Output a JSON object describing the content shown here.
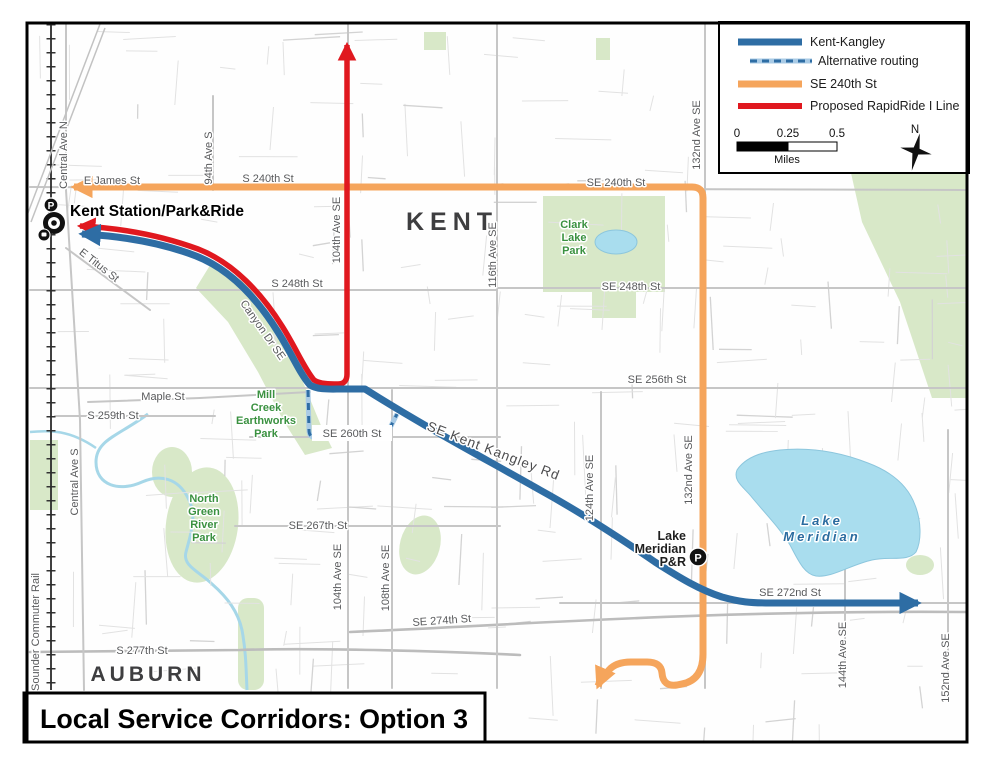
{
  "title_box": {
    "title": "Local Service Corridors: Option 3"
  },
  "legend": {
    "items": [
      {
        "label": "Kent-Kangley"
      },
      {
        "label": "Alternative routing"
      },
      {
        "label": "SE 240th St"
      },
      {
        "label": "Proposed RapidRide I Line"
      }
    ],
    "scale": {
      "ticks": [
        "0",
        "0.25",
        "0.5"
      ],
      "unit": "Miles"
    },
    "compass_n": "N"
  },
  "icons": {
    "p_badge": "P"
  },
  "colors": {
    "kent_kangley_blue": "#2e6da4",
    "alternative_light_blue": "#a9cbe6",
    "se_240th_orange": "#f5a55c",
    "rapidride_red": "#e0181f",
    "lake_blue": "#a9ddee",
    "park_green": "#d8e8c8",
    "park_text_green": "#3a9140"
  },
  "map_labels": [
    {
      "text": "E James St",
      "x": 112,
      "y": 184
    },
    {
      "text": "S 240th St",
      "x": 268,
      "y": 182
    },
    {
      "text": "SE 240th St",
      "x": 616,
      "y": 186
    },
    {
      "text": "S 248th St",
      "x": 297,
      "y": 287
    },
    {
      "text": "SE 248th St",
      "x": 631,
      "y": 290
    },
    {
      "text": "SE 256th St",
      "x": 657,
      "y": 383
    },
    {
      "text": "SE 260th St",
      "x": 352,
      "y": 437
    },
    {
      "text": "SE 267th St",
      "x": 318,
      "y": 529
    },
    {
      "text": "SE 272nd St",
      "x": 790,
      "y": 596
    },
    {
      "text": "SE 274th St",
      "x": 442,
      "y": 624,
      "rot": -4
    },
    {
      "text": "S 277th St",
      "x": 142,
      "y": 654
    },
    {
      "text": "S 259th St",
      "x": 113,
      "y": 419
    },
    {
      "text": "Maple St",
      "x": 163,
      "y": 400
    },
    {
      "text": "E Titus St",
      "x": 97,
      "y": 268,
      "rot": 38
    },
    {
      "text": "Canyon Dr SE",
      "x": 260,
      "y": 332,
      "rot": 55
    },
    {
      "text": "SE Kent Kangley Rd",
      "x": 492,
      "y": 455,
      "rot": 21,
      "cls": "road-lg"
    },
    {
      "text": "Central Ave N",
      "x": 67,
      "y": 155,
      "rot": -90
    },
    {
      "text": "Central Ave S",
      "x": 78,
      "y": 482,
      "rot": -90
    },
    {
      "text": "94th Ave S",
      "x": 212,
      "y": 158,
      "rot": -90
    },
    {
      "text": "104th Ave SE",
      "x": 340,
      "y": 230,
      "rot": -90
    },
    {
      "text": "104th Ave SE",
      "x": 341,
      "y": 577,
      "rot": -90
    },
    {
      "text": "108th Ave SE",
      "x": 389,
      "y": 578,
      "rot": -90
    },
    {
      "text": "116th Ave SE",
      "x": 496,
      "y": 255,
      "rot": -90
    },
    {
      "text": "124th Ave SE",
      "x": 593,
      "y": 488,
      "rot": -90
    },
    {
      "text": "132nd Ave SE",
      "x": 700,
      "y": 135,
      "rot": -90
    },
    {
      "text": "132nd Ave SE",
      "x": 692,
      "y": 470,
      "rot": -90
    },
    {
      "text": "144th Ave SE",
      "x": 846,
      "y": 655,
      "rot": -90
    },
    {
      "text": "152nd Ave SE",
      "x": 949,
      "y": 668,
      "rot": -90
    },
    {
      "text": "Sounder Commuter Rail",
      "x": 39,
      "y": 632,
      "rot": -90
    },
    {
      "text": "Clark",
      "x": 574,
      "y": 228,
      "cls": "park"
    },
    {
      "text": "Lake",
      "x": 574,
      "y": 241,
      "cls": "park"
    },
    {
      "text": "Park",
      "x": 574,
      "y": 254,
      "cls": "park"
    },
    {
      "text": "Mill",
      "x": 266,
      "y": 398,
      "cls": "park"
    },
    {
      "text": "Creek",
      "x": 266,
      "y": 411,
      "cls": "park"
    },
    {
      "text": "Earthworks",
      "x": 266,
      "y": 424,
      "cls": "park"
    },
    {
      "text": "Park",
      "x": 266,
      "y": 437,
      "cls": "park"
    },
    {
      "text": "North",
      "x": 204,
      "y": 502,
      "cls": "park"
    },
    {
      "text": "Green",
      "x": 204,
      "y": 515,
      "cls": "park"
    },
    {
      "text": "River",
      "x": 204,
      "y": 528,
      "cls": "park"
    },
    {
      "text": "Park",
      "x": 204,
      "y": 541,
      "cls": "park"
    },
    {
      "text": "Lake",
      "x": 822,
      "y": 525,
      "cls": "lake"
    },
    {
      "text": "Meridian",
      "x": 822,
      "y": 541,
      "cls": "lake"
    },
    {
      "text": "KENT",
      "x": 452,
      "y": 230,
      "cls": "city-lg"
    },
    {
      "text": "AUBURN",
      "x": 148,
      "y": 681,
      "cls": "city"
    },
    {
      "text": "Kent Station/Park&Ride",
      "x": 70,
      "y": 216,
      "cls": "station",
      "anchor": "start"
    },
    {
      "text": "Lake",
      "x": 686,
      "y": 540,
      "cls": "station-sm",
      "anchor": "end"
    },
    {
      "text": "Meridian",
      "x": 686,
      "y": 553,
      "cls": "station-sm",
      "anchor": "end"
    },
    {
      "text": "P&R",
      "x": 686,
      "y": 566,
      "cls": "station-sm",
      "anchor": "end"
    }
  ]
}
